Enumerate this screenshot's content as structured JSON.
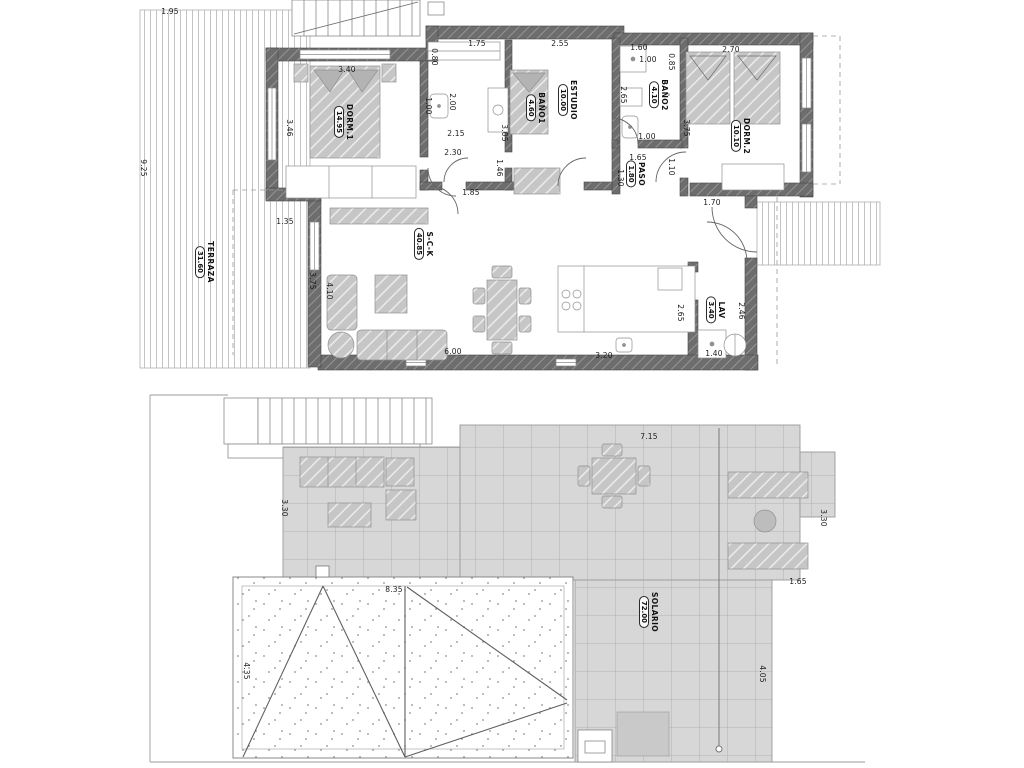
{
  "colors": {
    "wall": "#6d6d6d",
    "furniture": "#c6c6c6",
    "tile": "#d7d7d7",
    "deck_line": "#c4c4c4",
    "line": "#8a8a8a",
    "text": "#1c1c1c",
    "background": "#ffffff"
  },
  "room_labels": [
    {
      "name": "TERRAZA",
      "area": "31.60",
      "x": 205,
      "y": 262
    },
    {
      "name": "DORM.1",
      "area": "14.95",
      "x": 344,
      "y": 122
    },
    {
      "name": "BAÑO1",
      "area": "4.60",
      "x": 536,
      "y": 108
    },
    {
      "name": "ESTUDIO",
      "area": "10.00",
      "x": 568,
      "y": 100
    },
    {
      "name": "BAÑO2",
      "area": "4.10",
      "x": 659,
      "y": 95
    },
    {
      "name": "DORM.2",
      "area": "10.10",
      "x": 741,
      "y": 136
    },
    {
      "name": "PASO",
      "area": "1.80",
      "x": 636,
      "y": 174
    },
    {
      "name": "S-C-K",
      "area": "40.85",
      "x": 424,
      "y": 244
    },
    {
      "name": "LAV",
      "area": "3.40",
      "x": 716,
      "y": 310
    },
    {
      "name": "SOLARIO",
      "area": "72.00",
      "x": 649,
      "y": 612
    }
  ],
  "dimensions": [
    {
      "text": "1.95",
      "x": 170,
      "y": 12,
      "rot": "h"
    },
    {
      "text": "9.25",
      "x": 143,
      "y": 168,
      "rot": "v"
    },
    {
      "text": "3.40",
      "x": 347,
      "y": 70,
      "rot": "h"
    },
    {
      "text": "3.46",
      "x": 289,
      "y": 128,
      "rot": "v"
    },
    {
      "text": "2.00",
      "x": 452,
      "y": 102,
      "rot": "v"
    },
    {
      "text": "1.00",
      "x": 428,
      "y": 106,
      "rot": "v"
    },
    {
      "text": "0.80",
      "x": 434,
      "y": 57,
      "rot": "v"
    },
    {
      "text": "1.75",
      "x": 477,
      "y": 44,
      "rot": "h"
    },
    {
      "text": "2.15",
      "x": 456,
      "y": 134,
      "rot": "h"
    },
    {
      "text": "2.30",
      "x": 453,
      "y": 153,
      "rot": "h"
    },
    {
      "text": "1.46",
      "x": 499,
      "y": 168,
      "rot": "v"
    },
    {
      "text": "1.85",
      "x": 471,
      "y": 193,
      "rot": "h"
    },
    {
      "text": "2.55",
      "x": 560,
      "y": 44,
      "rot": "h"
    },
    {
      "text": "3.05",
      "x": 504,
      "y": 133,
      "rot": "v"
    },
    {
      "text": "1.60",
      "x": 639,
      "y": 48,
      "rot": "h"
    },
    {
      "text": "1.00",
      "x": 648,
      "y": 60,
      "rot": "h"
    },
    {
      "text": "0.85",
      "x": 671,
      "y": 62,
      "rot": "v"
    },
    {
      "text": "2.65",
      "x": 623,
      "y": 95,
      "rot": "v"
    },
    {
      "text": "1.00",
      "x": 647,
      "y": 137,
      "rot": "h"
    },
    {
      "text": "2.70",
      "x": 731,
      "y": 50,
      "rot": "h"
    },
    {
      "text": "3.75",
      "x": 686,
      "y": 128,
      "rot": "v"
    },
    {
      "text": "1.65",
      "x": 638,
      "y": 158,
      "rot": "h"
    },
    {
      "text": "1.10",
      "x": 671,
      "y": 167,
      "rot": "v"
    },
    {
      "text": "1.30",
      "x": 620,
      "y": 178,
      "rot": "v"
    },
    {
      "text": "1.70",
      "x": 712,
      "y": 203,
      "rot": "h"
    },
    {
      "text": "1.35",
      "x": 285,
      "y": 222,
      "rot": "h"
    },
    {
      "text": "3.75",
      "x": 312,
      "y": 281,
      "rot": "v"
    },
    {
      "text": "4.10",
      "x": 329,
      "y": 291,
      "rot": "v"
    },
    {
      "text": "6.00",
      "x": 453,
      "y": 352,
      "rot": "h"
    },
    {
      "text": "3.20",
      "x": 604,
      "y": 356,
      "rot": "h"
    },
    {
      "text": "2.65",
      "x": 680,
      "y": 313,
      "rot": "v"
    },
    {
      "text": "2.46",
      "x": 741,
      "y": 311,
      "rot": "v"
    },
    {
      "text": "1.40",
      "x": 714,
      "y": 354,
      "rot": "h"
    },
    {
      "text": "3.30",
      "x": 284,
      "y": 508,
      "rot": "v"
    },
    {
      "text": "7.15",
      "x": 649,
      "y": 437,
      "rot": "h"
    },
    {
      "text": "3.30",
      "x": 823,
      "y": 518,
      "rot": "v"
    },
    {
      "text": "1.65",
      "x": 798,
      "y": 582,
      "rot": "h"
    },
    {
      "text": "4.05",
      "x": 762,
      "y": 674,
      "rot": "v"
    },
    {
      "text": "8.35",
      "x": 394,
      "y": 590,
      "rot": "h"
    },
    {
      "text": "4.35",
      "x": 246,
      "y": 671,
      "rot": "v"
    }
  ]
}
